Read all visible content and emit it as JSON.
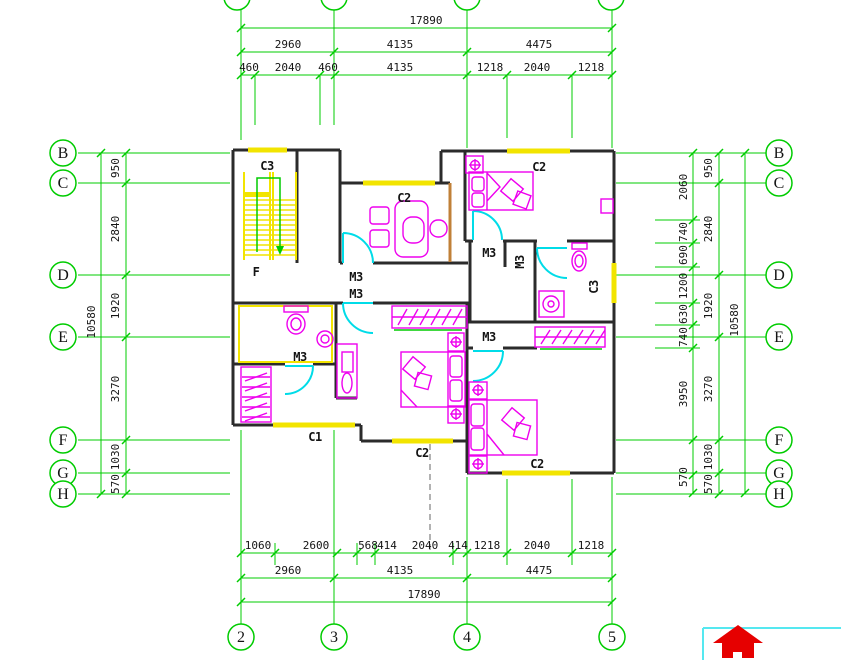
{
  "drawing": {
    "type": "architectural-floor-plan",
    "colors": {
      "grid_line": "#00cc00",
      "wall": "#2b2b2b",
      "window": "#f2e400",
      "door": "#00dce8",
      "furniture": "#ee00ee",
      "accent_wall": "#c08038",
      "logo_red": "#e60000",
      "logo_border": "#55e8f0"
    },
    "dimensions": {
      "top": {
        "overall": "17890",
        "row2": [
          "2960",
          "4135",
          "4475"
        ],
        "row3": [
          "460",
          "2040",
          "460",
          "4135",
          "1218",
          "2040",
          "1218"
        ]
      },
      "bottom": {
        "detail": [
          "1060",
          "2600",
          "568",
          "414",
          "2040",
          "414",
          "1218",
          "2040",
          "1218"
        ],
        "row2": [
          "2960",
          "4135",
          "4475"
        ],
        "overall": "17890"
      },
      "left": {
        "chain": [
          "950",
          "2840",
          "1920",
          "3270",
          "1030",
          "570"
        ],
        "overall": "10580"
      },
      "right": {
        "detail": [
          "2060",
          "740",
          "690",
          "1200",
          "630",
          "740",
          "3950",
          "570"
        ],
        "chain": [
          "950",
          "2840",
          "1920",
          "3270",
          "1030",
          "570"
        ],
        "overall": "10580"
      }
    },
    "room_marks": {
      "windows": [
        "C3",
        "C2",
        "C2",
        "C2",
        "C2",
        "C1",
        "C3"
      ],
      "doors": [
        "M3",
        "M3",
        "M3",
        "M3",
        "M3",
        "M3"
      ],
      "stair_mark": "F"
    }
  },
  "grid_bubbles": [
    {
      "n": "grid-bubble-left-B",
      "t": "B",
      "x": 63,
      "y": 153
    },
    {
      "n": "grid-bubble-left-C",
      "t": "C",
      "x": 63,
      "y": 183
    },
    {
      "n": "grid-bubble-left-D",
      "t": "D",
      "x": 63,
      "y": 275
    },
    {
      "n": "grid-bubble-left-E",
      "t": "E",
      "x": 63,
      "y": 337
    },
    {
      "n": "grid-bubble-left-F",
      "t": "F",
      "x": 63,
      "y": 440
    },
    {
      "n": "grid-bubble-left-G",
      "t": "G",
      "x": 63,
      "y": 473
    },
    {
      "n": "grid-bubble-left-H",
      "t": "H",
      "x": 63,
      "y": 494
    },
    {
      "n": "grid-bubble-right-B",
      "t": "B",
      "x": 779,
      "y": 153
    },
    {
      "n": "grid-bubble-right-C",
      "t": "C",
      "x": 779,
      "y": 183
    },
    {
      "n": "grid-bubble-right-D",
      "t": "D",
      "x": 779,
      "y": 275
    },
    {
      "n": "grid-bubble-right-E",
      "t": "E",
      "x": 779,
      "y": 337
    },
    {
      "n": "grid-bubble-right-F",
      "t": "F",
      "x": 779,
      "y": 440
    },
    {
      "n": "grid-bubble-right-G",
      "t": "G",
      "x": 779,
      "y": 473
    },
    {
      "n": "grid-bubble-right-H",
      "t": "H",
      "x": 779,
      "y": 494
    },
    {
      "n": "grid-bubble-bottom-2",
      "t": "2",
      "x": 241,
      "y": 637
    },
    {
      "n": "grid-bubble-bottom-3",
      "t": "3",
      "x": 334,
      "y": 637
    },
    {
      "n": "grid-bubble-bottom-4",
      "t": "4",
      "x": 467,
      "y": 637
    },
    {
      "n": "grid-bubble-bottom-5",
      "t": "5",
      "x": 612,
      "y": 637
    },
    {
      "n": "grid-bubble-top-2",
      "t": "",
      "x": 237,
      "y": -3
    },
    {
      "n": "grid-bubble-top-3",
      "t": "",
      "x": 334,
      "y": -3
    },
    {
      "n": "grid-bubble-top-4",
      "t": "",
      "x": 467,
      "y": -3
    },
    {
      "n": "grid-bubble-top-5",
      "t": "",
      "x": 611,
      "y": -3
    }
  ],
  "labels": [
    {
      "n": "dim-top-overall",
      "t": "17890",
      "x": 426,
      "y": 24,
      "c": "dim"
    },
    {
      "n": "dim-top2-1",
      "t": "2960",
      "x": 288,
      "y": 48,
      "c": "dim"
    },
    {
      "n": "dim-top2-2",
      "t": "4135",
      "x": 400,
      "y": 48,
      "c": "dim"
    },
    {
      "n": "dim-top2-3",
      "t": "4475",
      "x": 539,
      "y": 48,
      "c": "dim"
    },
    {
      "n": "dim-top3-1",
      "t": "460",
      "x": 249,
      "y": 71,
      "c": "dim"
    },
    {
      "n": "dim-top3-2",
      "t": "2040",
      "x": 288,
      "y": 71,
      "c": "dim"
    },
    {
      "n": "dim-top3-3",
      "t": "460",
      "x": 328,
      "y": 71,
      "c": "dim"
    },
    {
      "n": "dim-top3-4",
      "t": "4135",
      "x": 400,
      "y": 71,
      "c": "dim"
    },
    {
      "n": "dim-top3-5",
      "t": "1218",
      "x": 490,
      "y": 71,
      "c": "dim"
    },
    {
      "n": "dim-top3-6",
      "t": "2040",
      "x": 537,
      "y": 71,
      "c": "dim"
    },
    {
      "n": "dim-top3-7",
      "t": "1218",
      "x": 591,
      "y": 71,
      "c": "dim"
    },
    {
      "n": "dim-bot1-1",
      "t": "1060",
      "x": 258,
      "y": 549,
      "c": "dim"
    },
    {
      "n": "dim-bot1-2",
      "t": "2600",
      "x": 316,
      "y": 549,
      "c": "dim"
    },
    {
      "n": "dim-bot1-3",
      "t": "568",
      "x": 368,
      "y": 549,
      "c": "dim"
    },
    {
      "n": "dim-bot1-4",
      "t": "414",
      "x": 387,
      "y": 549,
      "c": "dim"
    },
    {
      "n": "dim-bot1-5",
      "t": "2040",
      "x": 425,
      "y": 549,
      "c": "dim"
    },
    {
      "n": "dim-bot1-6",
      "t": "414",
      "x": 458,
      "y": 549,
      "c": "dim"
    },
    {
      "n": "dim-bot1-7",
      "t": "1218",
      "x": 487,
      "y": 549,
      "c": "dim"
    },
    {
      "n": "dim-bot1-8",
      "t": "2040",
      "x": 537,
      "y": 549,
      "c": "dim"
    },
    {
      "n": "dim-bot1-9",
      "t": "1218",
      "x": 591,
      "y": 549,
      "c": "dim"
    },
    {
      "n": "dim-bot2-1",
      "t": "2960",
      "x": 288,
      "y": 574,
      "c": "dim"
    },
    {
      "n": "dim-bot2-2",
      "t": "4135",
      "x": 400,
      "y": 574,
      "c": "dim"
    },
    {
      "n": "dim-bot2-3",
      "t": "4475",
      "x": 539,
      "y": 574,
      "c": "dim"
    },
    {
      "n": "dim-bot-overall",
      "t": "17890",
      "x": 424,
      "y": 598,
      "c": "dim"
    },
    {
      "n": "dim-left-1",
      "t": "950",
      "x": 119,
      "y": 168,
      "c": "dim",
      "r": -90
    },
    {
      "n": "dim-left-2",
      "t": "2840",
      "x": 119,
      "y": 229,
      "c": "dim",
      "r": -90
    },
    {
      "n": "dim-left-3",
      "t": "1920",
      "x": 119,
      "y": 306,
      "c": "dim",
      "r": -90
    },
    {
      "n": "dim-left-4",
      "t": "3270",
      "x": 119,
      "y": 389,
      "c": "dim",
      "r": -90
    },
    {
      "n": "dim-left-5",
      "t": "1030",
      "x": 119,
      "y": 457,
      "c": "dim",
      "r": -90
    },
    {
      "n": "dim-left-6",
      "t": "570",
      "x": 119,
      "y": 484,
      "c": "dim",
      "r": -90
    },
    {
      "n": "dim-left-overall",
      "t": "10580",
      "x": 95,
      "y": 322,
      "c": "dim",
      "r": -90
    },
    {
      "n": "dim-right-chain-1",
      "t": "950",
      "x": 712,
      "y": 168,
      "c": "dim",
      "r": -90
    },
    {
      "n": "dim-right-chain-2",
      "t": "2840",
      "x": 712,
      "y": 229,
      "c": "dim",
      "r": -90
    },
    {
      "n": "dim-right-chain-3",
      "t": "1920",
      "x": 712,
      "y": 306,
      "c": "dim",
      "r": -90
    },
    {
      "n": "dim-right-chain-4",
      "t": "3270",
      "x": 712,
      "y": 389,
      "c": "dim",
      "r": -90
    },
    {
      "n": "dim-right-chain-5",
      "t": "1030",
      "x": 712,
      "y": 457,
      "c": "dim",
      "r": -90
    },
    {
      "n": "dim-right-chain-6",
      "t": "570",
      "x": 712,
      "y": 484,
      "c": "dim",
      "r": -90
    },
    {
      "n": "dim-right-overall",
      "t": "10580",
      "x": 738,
      "y": 320,
      "c": "dim",
      "r": -90
    },
    {
      "n": "dim-right-det-1",
      "t": "2060",
      "x": 687,
      "y": 187,
      "c": "dim",
      "r": -90
    },
    {
      "n": "dim-right-det-2",
      "t": "740",
      "x": 687,
      "y": 232,
      "c": "dim",
      "r": -90
    },
    {
      "n": "dim-right-det-3",
      "t": "690",
      "x": 687,
      "y": 255,
      "c": "dim",
      "r": -90
    },
    {
      "n": "dim-right-det-4",
      "t": "1200",
      "x": 687,
      "y": 286,
      "c": "dim",
      "r": -90
    },
    {
      "n": "dim-right-det-5",
      "t": "630",
      "x": 687,
      "y": 314,
      "c": "dim",
      "r": -90
    },
    {
      "n": "dim-right-det-6",
      "t": "740",
      "x": 687,
      "y": 337,
      "c": "dim",
      "r": -90
    },
    {
      "n": "dim-right-det-7",
      "t": "3950",
      "x": 687,
      "y": 394,
      "c": "dim",
      "r": -90
    },
    {
      "n": "dim-right-det-8",
      "t": "570",
      "x": 687,
      "y": 477,
      "c": "dim",
      "r": -90
    },
    {
      "n": "window-label-c3-stair",
      "t": "C3",
      "x": 267,
      "y": 170,
      "c": "room"
    },
    {
      "n": "window-label-c2-office",
      "t": "C2",
      "x": 404,
      "y": 202,
      "c": "room"
    },
    {
      "n": "window-label-c2-bedroom-tr",
      "t": "C2",
      "x": 539,
      "y": 171,
      "c": "room"
    },
    {
      "n": "door-label-m3-hall-a",
      "t": "M3",
      "x": 356,
      "y": 281,
      "c": "room"
    },
    {
      "n": "door-label-m3-hall-b",
      "t": "M3",
      "x": 356,
      "y": 298,
      "c": "room"
    },
    {
      "n": "stair-direction-label",
      "t": "F",
      "x": 256,
      "y": 276,
      "c": "room"
    },
    {
      "n": "door-label-m3-bath1",
      "t": "M3",
      "x": 300,
      "y": 361,
      "c": "room"
    },
    {
      "n": "door-label-m3-bedroom-tr",
      "t": "M3",
      "x": 489,
      "y": 257,
      "c": "room"
    },
    {
      "n": "door-label-m3-bath2",
      "t": "M3",
      "x": 524,
      "y": 262,
      "c": "room",
      "r": -90
    },
    {
      "n": "window-label-c3-bath2",
      "t": "C3",
      "x": 598,
      "y": 287,
      "c": "room",
      "r": -90
    },
    {
      "n": "door-label-m3-bedroom-br",
      "t": "M3",
      "x": 489,
      "y": 341,
      "c": "room"
    },
    {
      "n": "window-label-c2-bedroom-bc",
      "t": "C2",
      "x": 422,
      "y": 457,
      "c": "room"
    },
    {
      "n": "window-label-c1",
      "t": "C1",
      "x": 315,
      "y": 441,
      "c": "room"
    },
    {
      "n": "window-label-c2-bedroom-br",
      "t": "C2",
      "x": 537,
      "y": 468,
      "c": "room"
    }
  ]
}
